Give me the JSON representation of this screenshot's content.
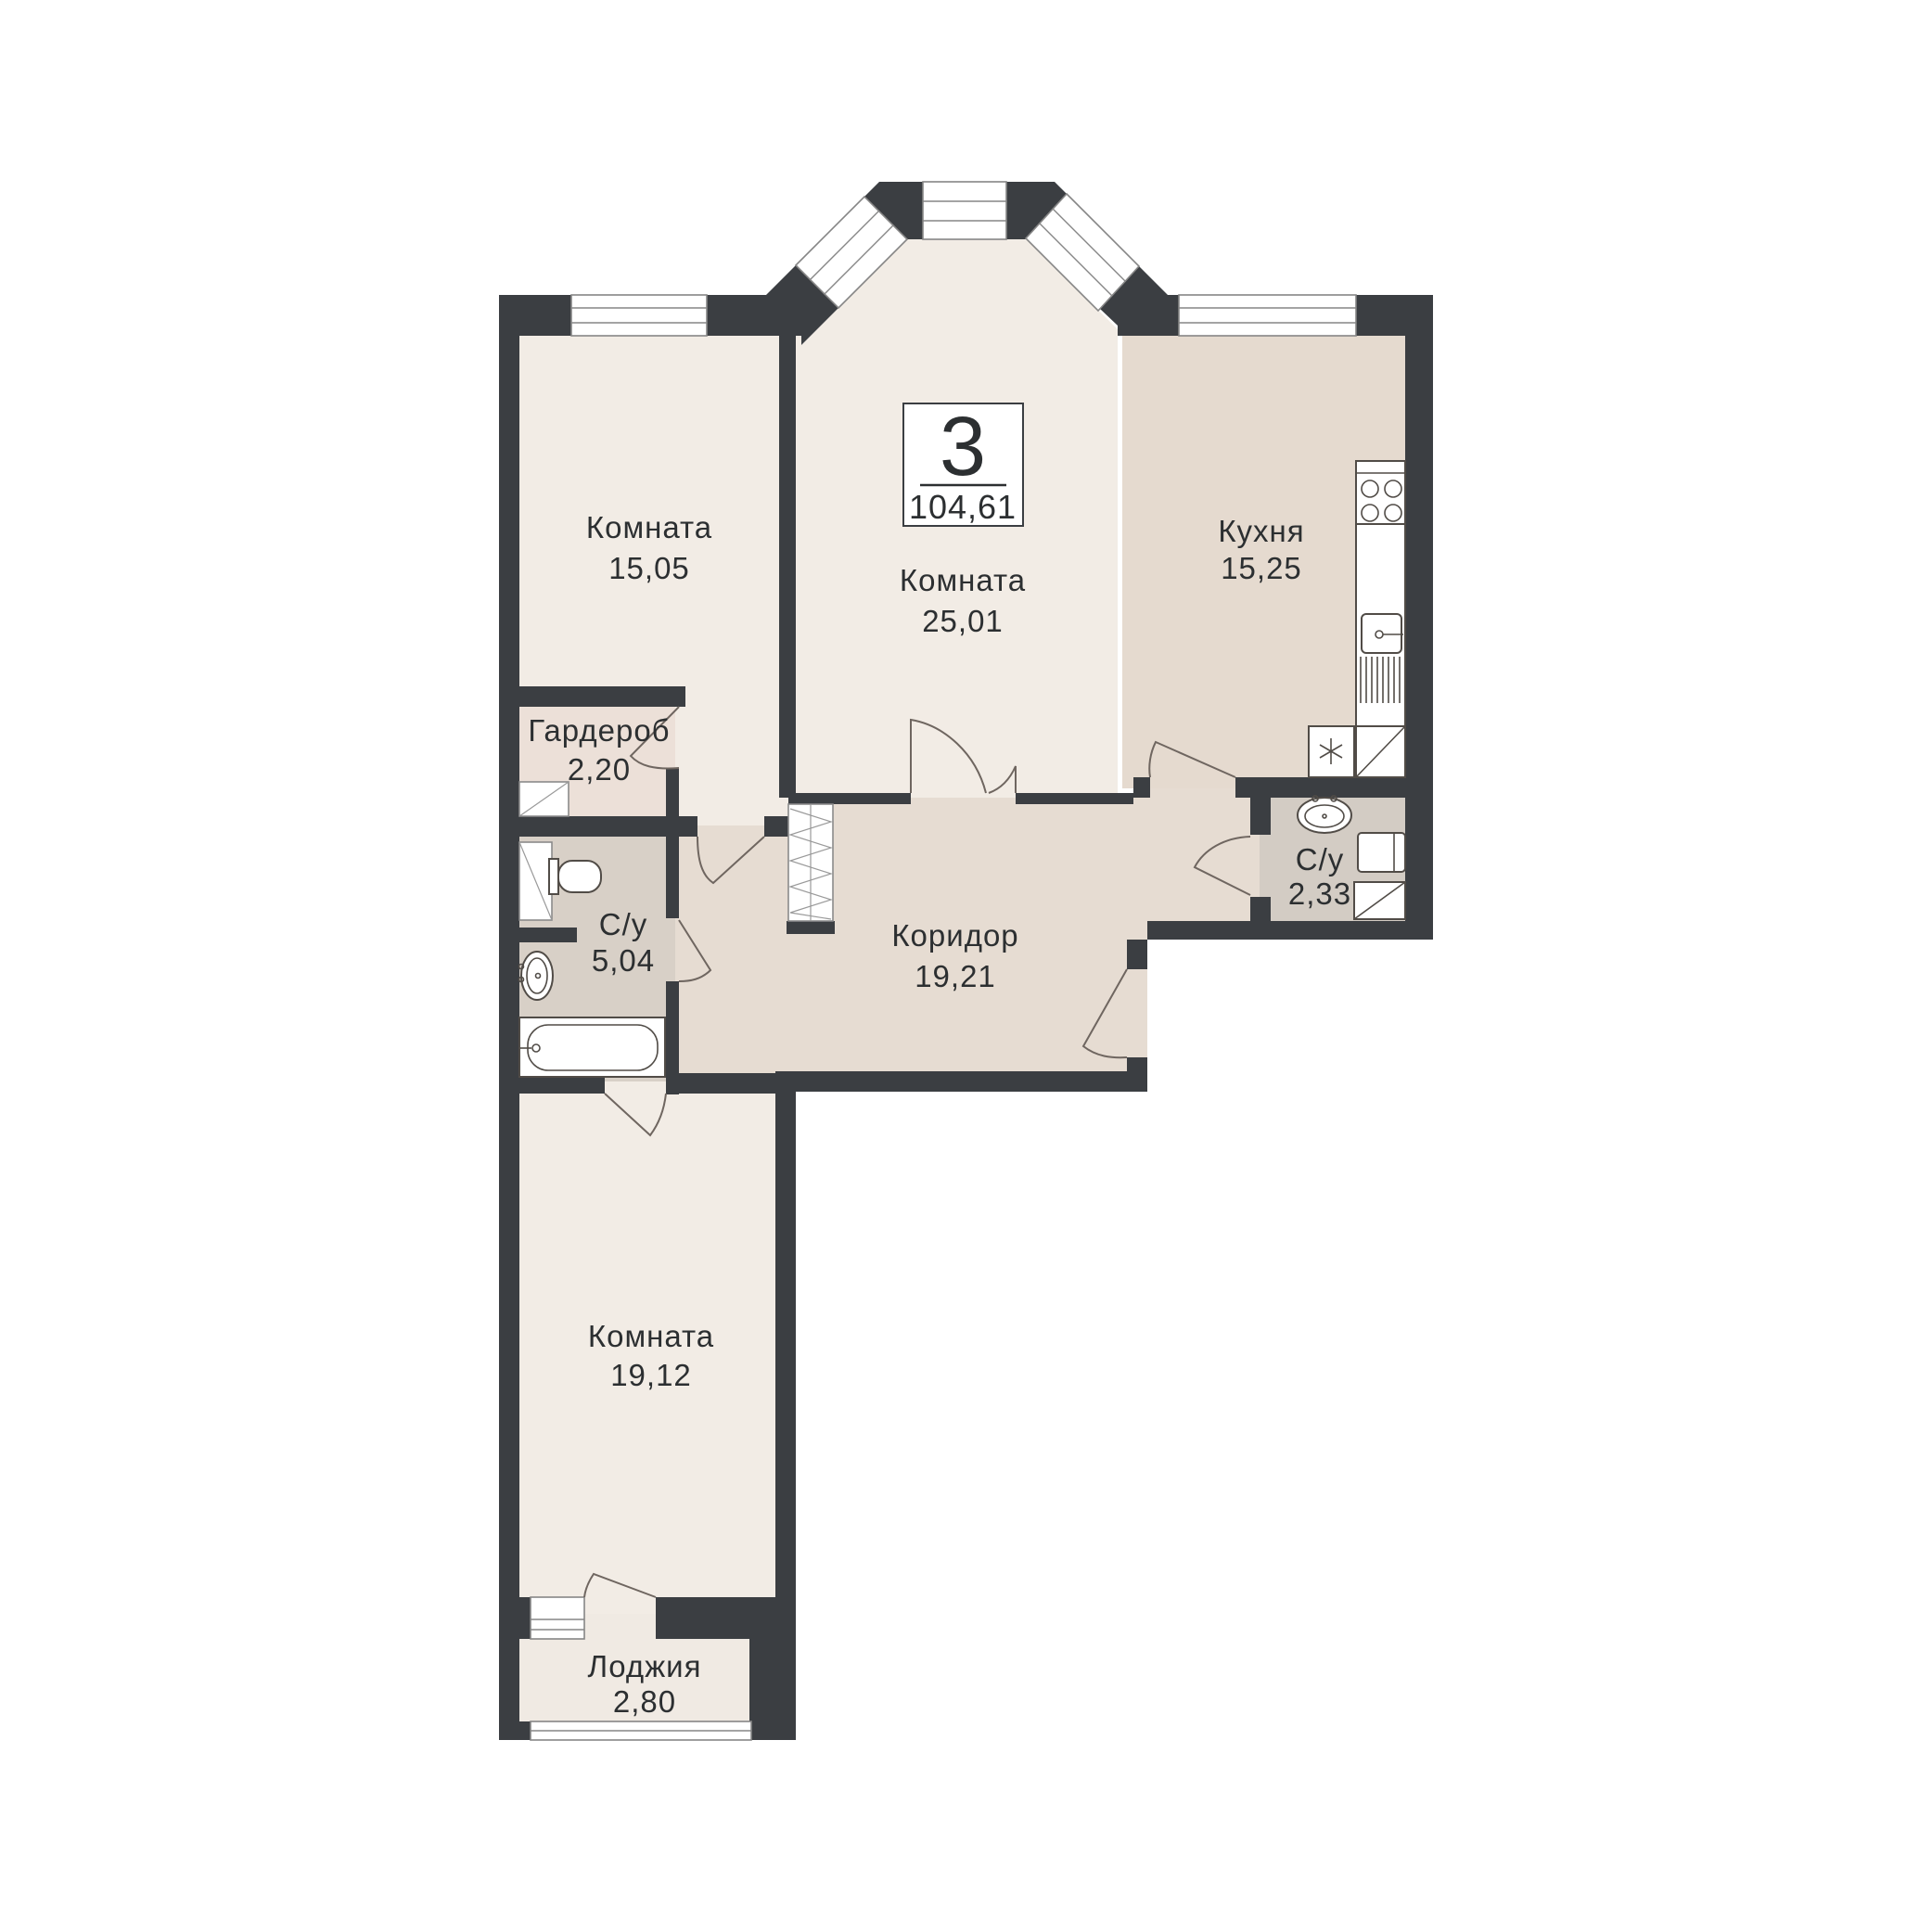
{
  "unit": {
    "rooms_count": "3",
    "total_area": "104,61"
  },
  "rooms": [
    {
      "id": "room-15",
      "name": "Комната",
      "area": "15,05"
    },
    {
      "id": "room-25",
      "name": "Комната",
      "area": "25,01"
    },
    {
      "id": "kitchen",
      "name": "Кухня",
      "area": "15,25"
    },
    {
      "id": "wardrobe",
      "name": "Гардероб",
      "area": "2,20"
    },
    {
      "id": "bath-main",
      "name": "С/у",
      "area": "5,04"
    },
    {
      "id": "corridor",
      "name": "Коридор",
      "area": "19,21"
    },
    {
      "id": "bath-guest",
      "name": "С/у",
      "area": "2,33"
    },
    {
      "id": "room-19",
      "name": "Комната",
      "area": "19,12"
    },
    {
      "id": "loggia",
      "name": "Лоджия",
      "area": "2,80"
    }
  ],
  "colors": {
    "wall": "#3b3e42",
    "room": "#f2ece5",
    "kitchen": "#e5dacf",
    "corridor": "#e6dcd2",
    "wardrobe": "#ece0d8",
    "bathroom": "#d8d0c7",
    "bathroom_small": "#d3ccc4",
    "loggia": "#f0eae3",
    "text": "#2c2f31",
    "paper": "#ffffff"
  },
  "icons": {
    "fixtures": [
      "stove-icon",
      "kitchen-sink-icon",
      "dishwasher-icon",
      "fridge-icon",
      "corner-cabinet-icon",
      "sink-icon",
      "washing-machine-icon",
      "shower-cabinet-icon",
      "toilet-icon",
      "bathtub-icon",
      "closet-rail-icon",
      "duct-shaft-icon",
      "window-icon",
      "door-arc-icon"
    ]
  }
}
